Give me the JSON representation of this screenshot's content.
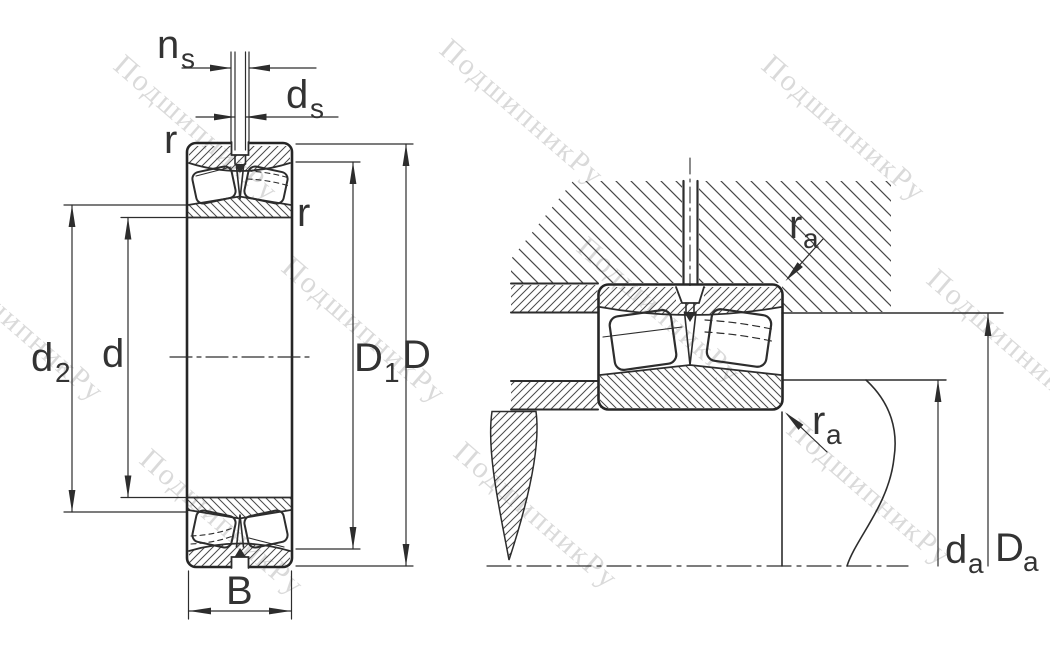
{
  "drawing": {
    "title_hint": "spherical roller bearing cross-section and mounting drawing",
    "watermark": {
      "text": "ПодшипникРу"
    },
    "labels": {
      "ns": {
        "main": "n",
        "sub": "s"
      },
      "ds": {
        "main": "d",
        "sub": "s"
      },
      "r_outer": "r",
      "r_inner": "r",
      "d2": {
        "main": "d",
        "sub": "2"
      },
      "d": "d",
      "D1": {
        "main": "D",
        "sub": "1"
      },
      "D": "D",
      "B": "B",
      "ra_housing": {
        "main": "r",
        "sub": "a"
      },
      "ra_shaft": {
        "main": "r",
        "sub": "a"
      },
      "da": {
        "main": "d",
        "sub": "a"
      },
      "Da": {
        "main": "D",
        "sub": "a"
      }
    },
    "colors": {
      "line": "#2d2d2d",
      "hatch": "#4a4a4a",
      "label": "#333333",
      "watermark": "#d9d9d9",
      "background": "#ffffff"
    }
  }
}
